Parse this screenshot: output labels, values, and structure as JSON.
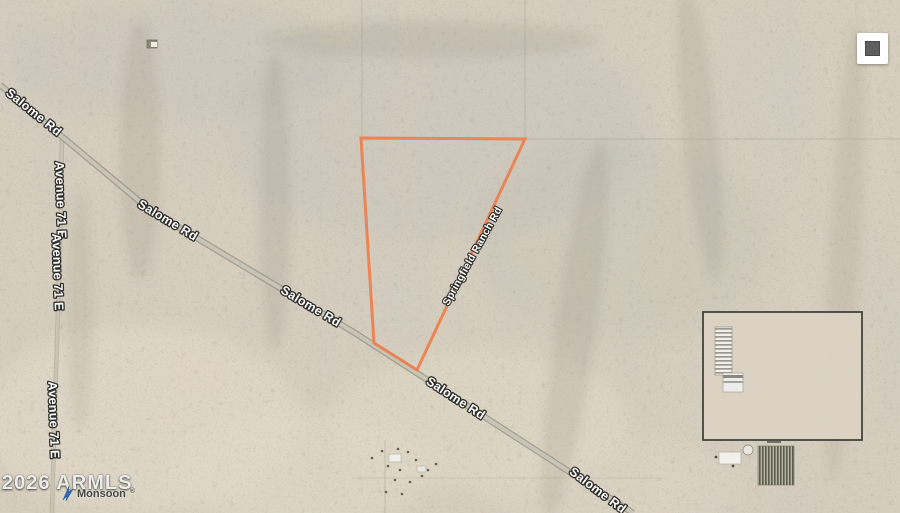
{
  "map": {
    "imagery": "desert satellite view",
    "roads": {
      "salome_rd": "Salome Rd",
      "avenue_71_e": "Avenue 71 E",
      "springfield_ranch_rd": "Springfield Ranch Rd"
    },
    "parcel": {
      "outline_color": "#EE7E4D"
    },
    "attribution": {
      "copyright": "2026 ARMLS",
      "brand": "Monsoon",
      "registered_mark": "®",
      "brand_color": "#2D6FC0"
    },
    "controls": {
      "square_button_icon": "filled-square"
    }
  }
}
